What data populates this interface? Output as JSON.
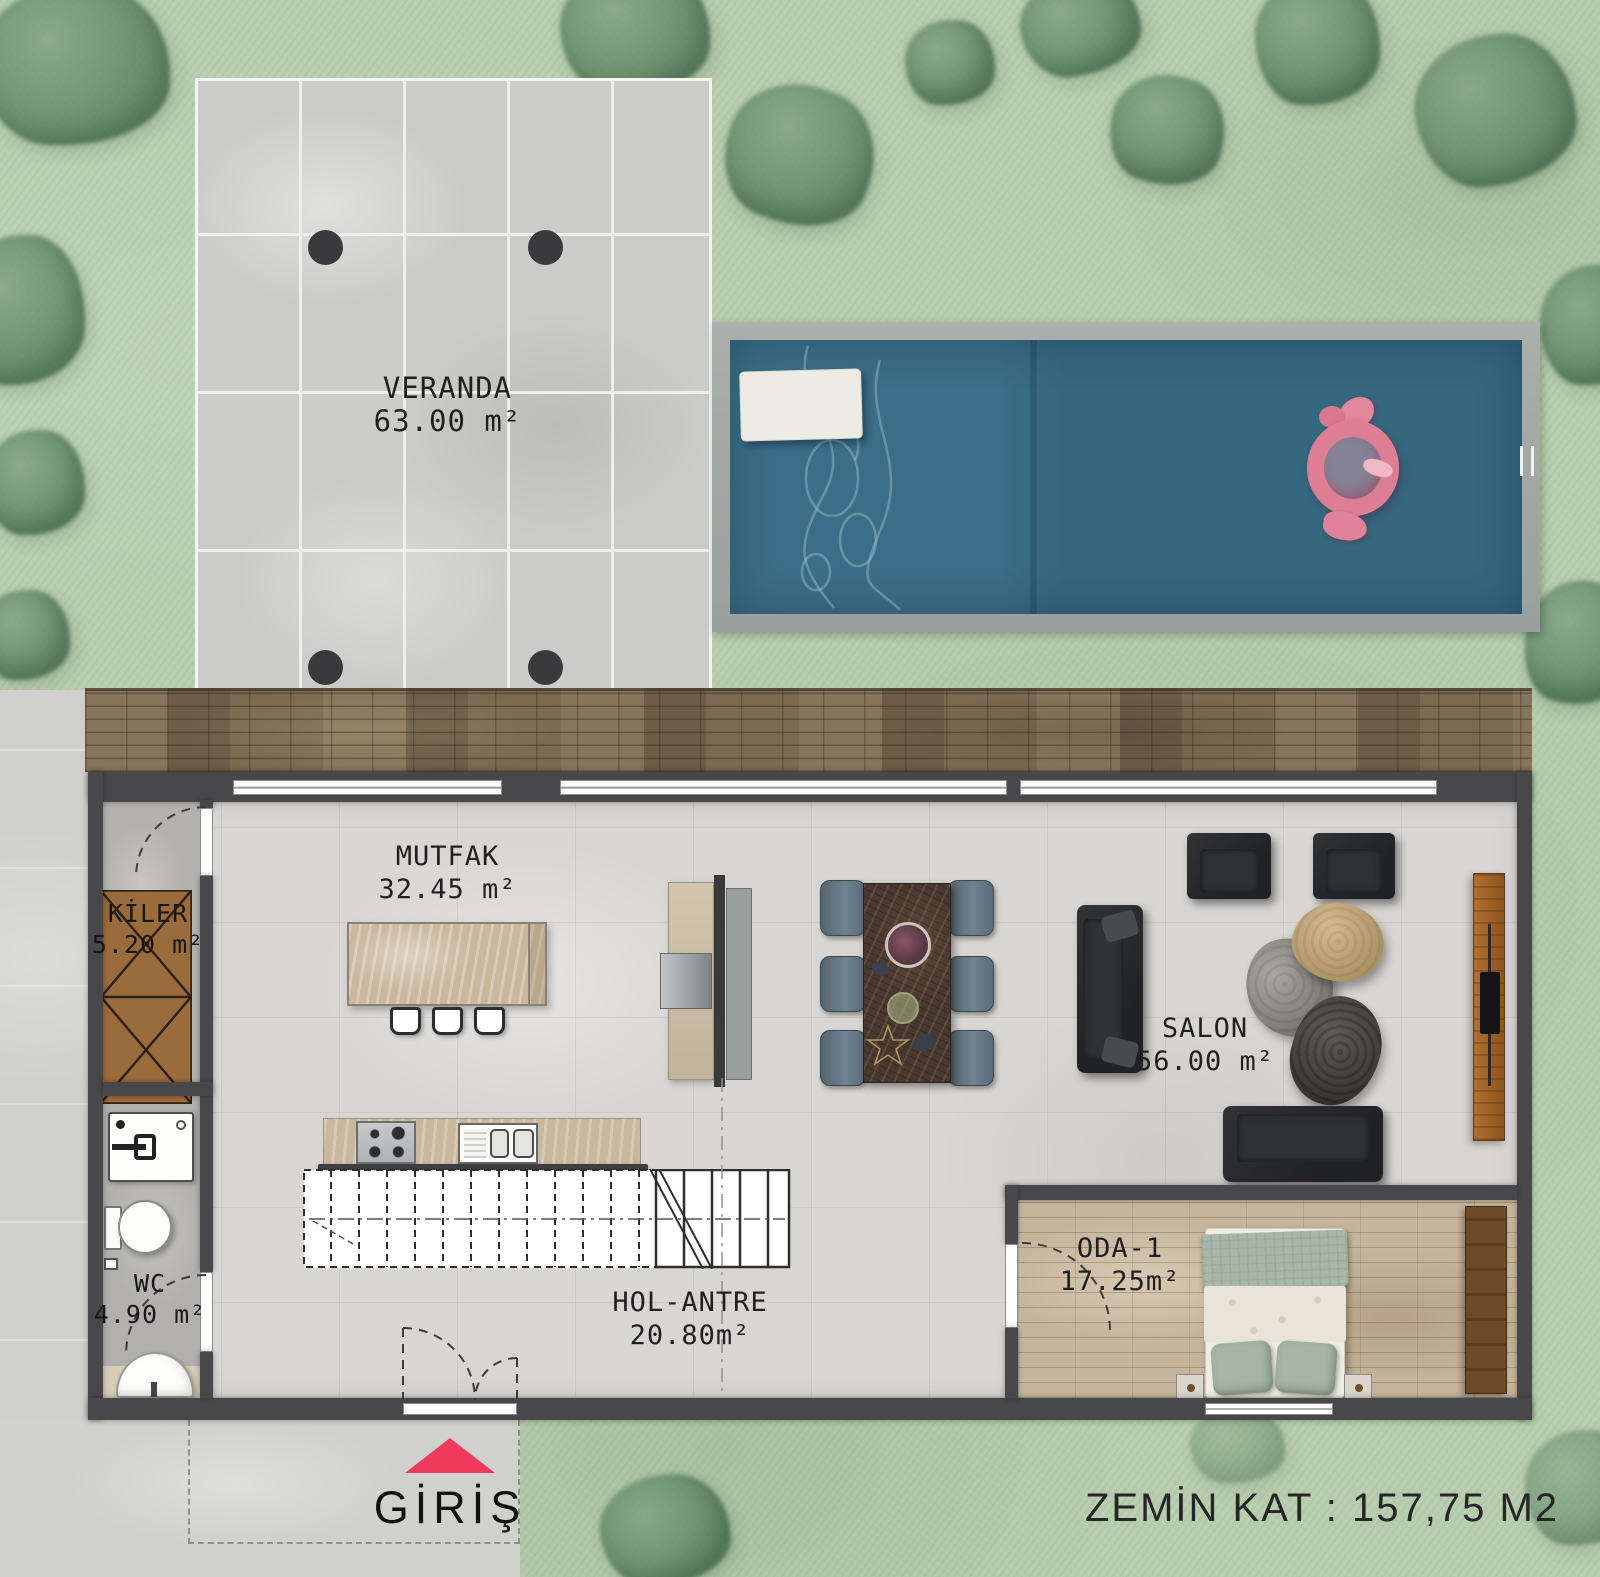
{
  "title": "ZEMİN KAT : 157,75 M2",
  "entrance": {
    "label": "GİRİŞ",
    "arrow_color": "#ee3b5c"
  },
  "rooms": {
    "veranda": {
      "name": "VERANDA",
      "area": "63.00 m²"
    },
    "mutfak": {
      "name": "MUTFAK",
      "area": "32.45 m²"
    },
    "kiler": {
      "name": "KİLER",
      "area": "5.20 m²"
    },
    "wc": {
      "name": "WC",
      "area": "4.90 m²"
    },
    "hol": {
      "name": "HOL-ANTRE",
      "area": "20.80m²"
    },
    "salon": {
      "name": "SALON",
      "area": "56.00 m²"
    },
    "oda1": {
      "name": "ODA-1",
      "area": "17.25m²"
    }
  },
  "colors": {
    "grass": "#b7cdad",
    "tree": "#5f8a66",
    "pool_water": "#36687f",
    "wall": "#48484a",
    "floor": "#d8d6d3",
    "deck": "#7a6a52",
    "accent_red": "#ee3b5c",
    "marble": "#c9b79e",
    "text": "#1f1f1f"
  }
}
